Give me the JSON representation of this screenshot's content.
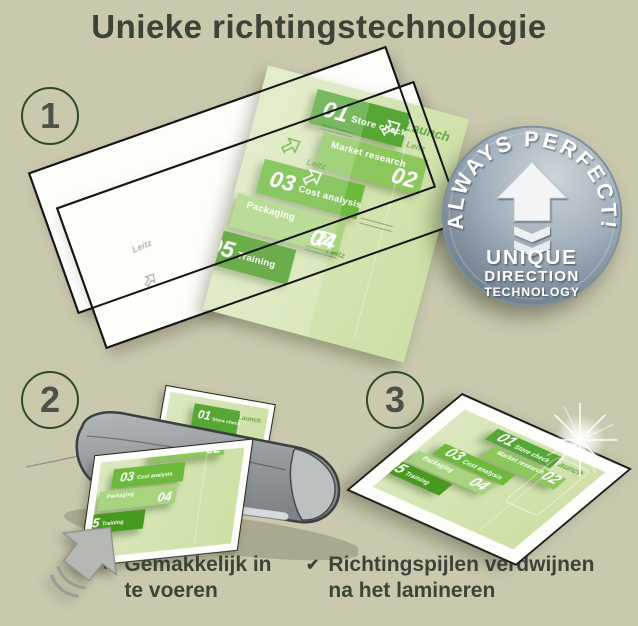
{
  "title": "Unieke richtingstechnologie",
  "steps": [
    {
      "number": "1"
    },
    {
      "number": "2"
    },
    {
      "number": "3"
    }
  ],
  "badge": {
    "arc_text": "ALWAYS PERFECT!",
    "line1": "UNIQUE",
    "line2": "DIRECTION",
    "line3": "TECHNOLOGY"
  },
  "chart": {
    "launch_label": "Launch",
    "brand": "Leitz",
    "rows": [
      {
        "num": "01",
        "label": "Store check",
        "color": "#57a736"
      },
      {
        "num": "02",
        "label": "Market research",
        "color": "#8cc75c"
      },
      {
        "num": "03",
        "label": "Cost analysis",
        "color": "#6db93c"
      },
      {
        "num": "04",
        "label": "Packaging",
        "color": "#a9d47f"
      },
      {
        "num": "05",
        "label": "Training",
        "color": "#47991f"
      }
    ]
  },
  "captions": [
    {
      "check": "✔",
      "line1": "Gemakkelijk in",
      "line2": "te voeren"
    },
    {
      "check": "✔",
      "line1": "Richtingspijlen verdwijnen",
      "line2": "na het lamineren"
    }
  ],
  "colors": {
    "background": "#cac9ae",
    "text": "#3e4338",
    "circle_border": "#2e4b28",
    "doc_green": "#d2e2ab",
    "badge_light": "#ccd5da",
    "badge_dark": "#617382",
    "laminator_gray": "#8f9496",
    "arrow_gray": "#b6b8b3"
  }
}
